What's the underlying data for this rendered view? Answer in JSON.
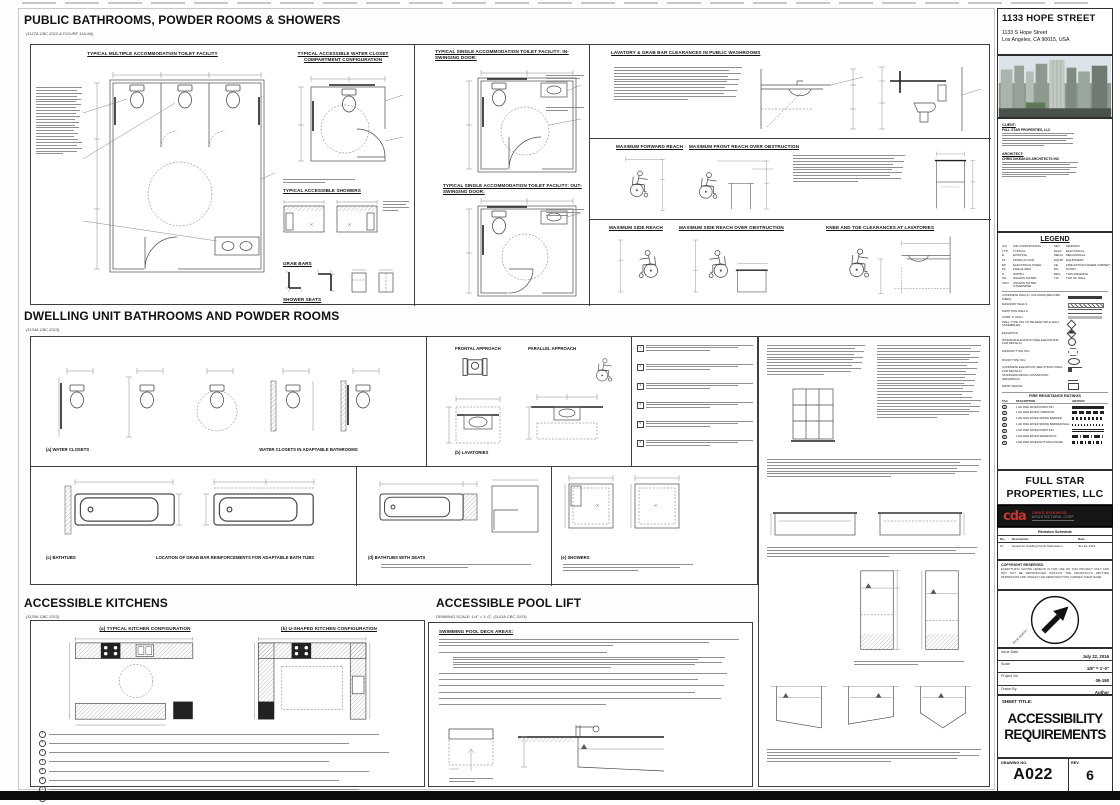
{
  "sheet": {
    "sections": {
      "public": {
        "title": "PUBLIC BATHROOMS, POWDER ROOMS & SHOWERS",
        "subtitle": "(1127A CBC 2013 & FIGURE 11A-9A)",
        "headings": {
          "multiple": "TYPICAL MULTIPLE ACCOMMODATION TOILET FACILITY",
          "compartment": "TYPICAL ACCESSIBLE WATER CLOSET COMPARTMENT CONFIGURATION",
          "showers": "TYPICAL ACCESSIBLE SHOWERS",
          "grab_bars": "GRAB BARS",
          "shower_seats": "SHOWER SEATS",
          "single_in": "TYPICAL SINGLE ACCOMMODATION TOILET FACILITY: IN-SWINGING DOOR:",
          "single_out": "TYPICAL SINGLE ACCOMMODATION TOILET FACILITY: OUT-SWINGING DOOR:",
          "lav_clearances": "LAVATORY & GRAB BAR CLEARANCES IN PUBLIC WASHROOMS",
          "fwd_reach": "MAXIMUM FORWARD REACH",
          "front_reach_obstruction": "MAXIMUM FRONT REACH OVER OBSTRUCTION",
          "side_reach": "MAXIMUM SIDE REACH",
          "side_reach_obstruction": "MAXIMUM SIDE REACH OVER OBSTRUCTION",
          "knee_toe": "KNEE AND TOE CLEARANCES AT LAVATORIES"
        }
      },
      "dwelling": {
        "title": "DWELLING UNIT BATHROOMS AND POWDER ROOMS",
        "subtitle": "(1134A CBC 2013)",
        "labels": {
          "water_closets": "(a) WATER CLOSETS",
          "adaptable": "WATER CLOSETS IN ADAPTABLE BATHROOMS",
          "frontal": "FRONTAL APPROACH",
          "parallel": "PARALLEL APPROACH",
          "lavatories": "(b) LAVATORIES",
          "bathtubs": "(c) BATHTUBS",
          "grab_location": "LOCATION OF GRAB BAR REINFORCEMENTS FOR ADAPTABLE BATH TUBS",
          "tub_seats": "(d) BATHTUBS WITH SEATS",
          "showers": "(e) SHOWERS"
        }
      },
      "kitchens": {
        "title": "ACCESSIBLE KITCHENS",
        "subtitle": "(1135A CBC 2013)",
        "labels": {
          "typical": "(a) TYPICAL KITCHEN CONFIGURATION",
          "ushaped": "(b) U-SHAPED KITCHEN CONFIGURATION"
        }
      },
      "pool": {
        "title": "ACCESSIBLE POOL LIFT",
        "subtitle": "DRAWING SCALE: 1/4\" = 1'-0\". (1141A CBC 2013)",
        "deck_heading": "SWIMMING POOL DECK AREAS:"
      }
    },
    "titleblock": {
      "project_name": "1133 HOPE STREET",
      "address1": "1133 S Hope Street",
      "address2": "Los Angeles, CA 90015, USA",
      "client_label": "CLIENT:",
      "client_name": "FULL STAR PROPERTIES, LLC",
      "architect_label": "ARCHITECT:",
      "architect_name": "CHRIS DIKEAKOS ARCHITECTS INC",
      "legend": {
        "title": "LEGEND",
        "abbr": [
          [
            "A/C",
            "AIR CONDITIONING",
            "MIN",
            "MINIMUM"
          ],
          [
            "TYP",
            "TYPICAL",
            "ELEC",
            "ELECTRICAL"
          ],
          [
            "E",
            "EXISTING",
            "MECH",
            "MECHANICAL"
          ],
          [
            "FF",
            "FINISH FLOOR",
            "EQUIP",
            "EQUIPMENT"
          ],
          [
            "EP",
            "ELECTRICAL PANEL",
            "FE",
            "FIRE EXTINGUISHER CABINET"
          ],
          [
            "FA",
            "FIRE ALARM",
            "DN",
            "DOWN"
          ],
          [
            "N",
            "NORTH",
            "DRG",
            "THIS DRAWING"
          ],
          [
            "UN",
            "UNLESS NOTED",
            "TW",
            "TOP OF WALL"
          ],
          [
            "UNO",
            "UNLESS NOTED OTHERWISE",
            "",
            ""
          ]
        ],
        "symbols": [
          {
            "label": "CONCRETE WALLS / COLUMNS (RECORD SIZES)",
            "type": "solid"
          },
          {
            "label": "MASONRY WALLS",
            "type": "hatch"
          },
          {
            "label": "PARTITION WALLS",
            "type": "lines"
          },
          {
            "label": "CURB, 6\" HIGH",
            "type": "grey"
          },
          {
            "label": "WALL TYPE TAG TO BE READ WITH WALL ASSEMBLIES",
            "type": "diamond"
          },
          {
            "label": "ELEVATION",
            "type": "elev"
          },
          {
            "label": "INTERIOR ELEVATION (SEE ELEVATIONS FOR DETAILS)",
            "type": "circle"
          },
          {
            "label": "WINDOW TYPE TAG",
            "type": "hex"
          },
          {
            "label": "DOOR TYPE TAG",
            "type": "oval"
          },
          {
            "label": "CONCRETE ELEVATION (SEE STRUCTURAL FOR DETAILS)",
            "type": "step"
          },
          {
            "label": "STANDARD DETAIL CONVENTION (DRAWINGS)",
            "type": "detail"
          },
          {
            "label": "DROP CEILING",
            "type": "rect"
          }
        ]
      },
      "fire": {
        "title": "FIRE RESISTANCE RATINGS",
        "cols": [
          "TAG",
          "DESCRIPTION",
          "GRAPHIC"
        ],
        "rows": [
          {
            "desc": "1 HR FIRE RATED PARTITION",
            "pattern": "p1"
          },
          {
            "desc": "1 HR FIRE RATED CORRIDOR",
            "pattern": "p2"
          },
          {
            "desc": "1 HR FIRE RATED SMOKE BARRIER",
            "pattern": "p3"
          },
          {
            "desc": "1 HR FIRE RATED SMOKE BARRIER WALL",
            "pattern": "p4"
          },
          {
            "desc": "2 HR FIRE RATED PARTITION",
            "pattern": "p5"
          },
          {
            "desc": "2 HR FIRE RATED SEPARATION",
            "pattern": "p6"
          },
          {
            "desc": "2 HR FIRE RATED EXIT ENCLOSURE",
            "pattern": "p7"
          }
        ]
      },
      "owner_line1": "FULL STAR",
      "owner_line2": "PROPERTIES, LLC",
      "logo": {
        "mark": "cda",
        "line1": "CHRIS DIKEAKOS",
        "line2": "ARCHITECTURAL CORP"
      },
      "revision": {
        "title": "Revision Schedule",
        "cols": [
          "No.",
          "Description",
          "Date"
        ],
        "rows": [
          [
            "10",
            "Issued for Grading Permit Submission",
            "Jun 24, 2016"
          ]
        ]
      },
      "copyright_label": "COPYRIGHT RESERVED.",
      "copyright_text": "EVERYTHING SHOWN HEREON IS FOR USE ON THIS PROJECT ONLY AND MAY NOT BE REPRODUCED WITHOUT THE ARCHITECT'S WRITTEN PERMISSION AND UNLESS THE REPRODUCTION CARRIES THEIR NAME.",
      "north_label": "TRUE NORTH",
      "fields": [
        {
          "label": "Issue Date",
          "value": "July 22, 2016"
        },
        {
          "label": "Scale",
          "value": "1/8\" = 1'-0\""
        },
        {
          "label": "Project No.",
          "value": "06-190"
        },
        {
          "label": "Drawn By",
          "value": "Author"
        }
      ],
      "sheet_title_label": "SHEET TITLE:",
      "sheet_title_line1": "ACCESSIBILITY",
      "sheet_title_line2": "REQUIREMENTS",
      "drawing_no_label": "DRAWING NO.",
      "drawing_no": "A022",
      "rev_label": "REV.",
      "rev": "6"
    }
  }
}
